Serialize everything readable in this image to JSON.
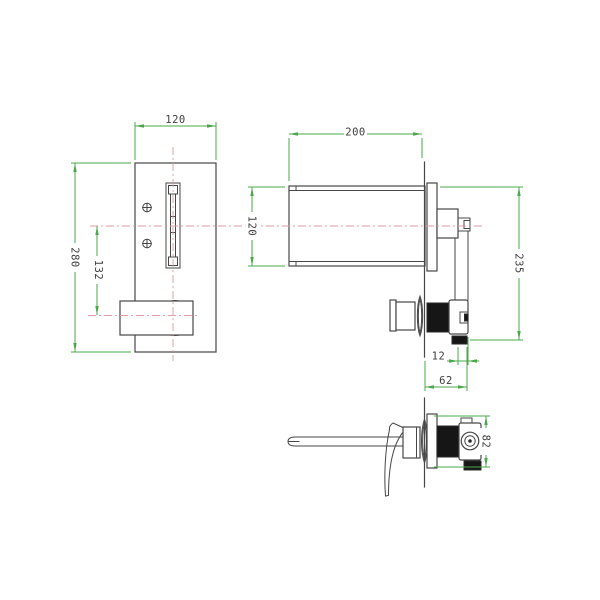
{
  "drawing": {
    "type": "technical-drawing",
    "product": "wall-mounted waterfall basin mixer",
    "views": {
      "front": "front view of wall plate with waterfall slot and handle",
      "side": "side section view of spout and concealed valve body",
      "assembled": "assembled side view with lever handle"
    },
    "dimensions": {
      "plate_width": "120",
      "plate_height": "280",
      "spout_to_handle": "132",
      "spout_length": "200",
      "spout_height": "120",
      "overall_height": "235",
      "connector_width": "12",
      "valve_depth": "62",
      "valve_height": "82"
    },
    "colors": {
      "dimension_green": "#4aa84a",
      "centerline_red": "#dc9e9e",
      "object_line": "#474747",
      "fill_black": "#161616",
      "background": "#ffffff"
    }
  }
}
